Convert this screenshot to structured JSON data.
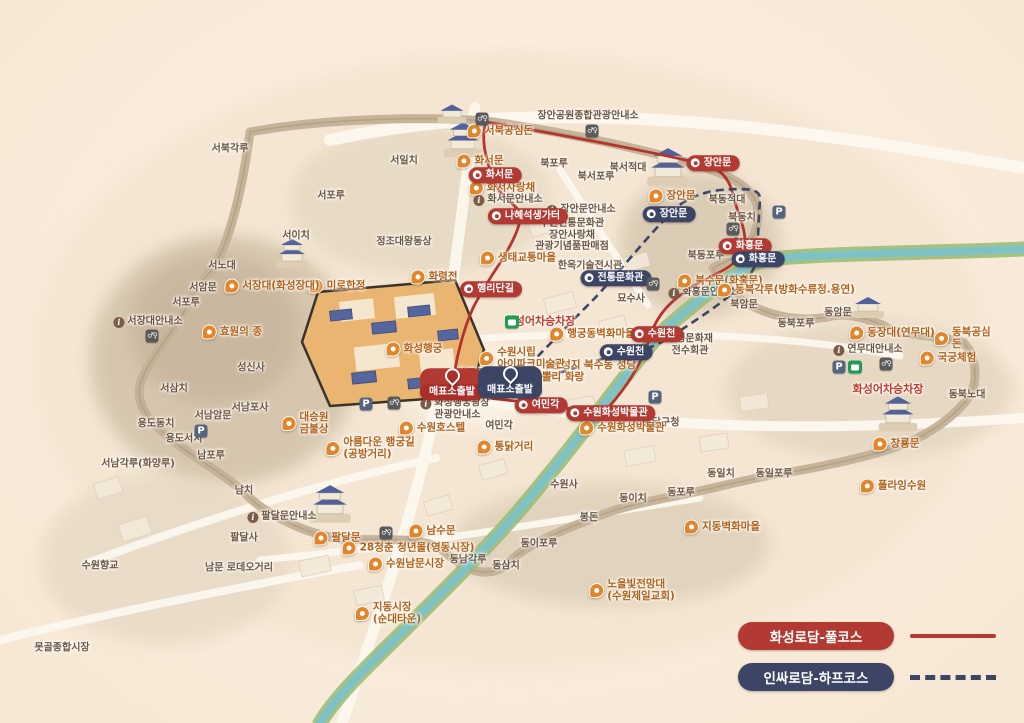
{
  "map_title": "수원 화성 관광 안내도",
  "colors": {
    "full_course_red": "#b23a33",
    "half_course_navy": "#3c4565",
    "poi_orange": "#e2862c",
    "place_brown": "#6d5640",
    "stream_green": "#9dbd74",
    "stream_water": "#7fc2c6",
    "background": "#f9ecdb"
  },
  "legend": {
    "items": [
      {
        "label": "화성로담-풀코스",
        "color": "#b23a33",
        "line": "solid"
      },
      {
        "label": "인싸로담-하프코스",
        "color": "#3c4565",
        "line": "dashed"
      }
    ]
  },
  "labels": [
    {
      "type": "place",
      "text": "장안공원종합관광안내소",
      "x": 588,
      "y": 116,
      "name": "place-jangan-park-tourist-info"
    },
    {
      "type": "place",
      "text": "서북각루",
      "x": 230,
      "y": 149,
      "name": "place-seobukgangnu"
    },
    {
      "type": "place",
      "text": "서일치",
      "x": 404,
      "y": 161,
      "name": "place-seoilchi"
    },
    {
      "type": "place",
      "text": "서포루",
      "x": 331,
      "y": 196,
      "name": "place-seoporu-1"
    },
    {
      "type": "place",
      "text": "서이치",
      "x": 296,
      "y": 236,
      "name": "place-seoichi"
    },
    {
      "type": "place",
      "text": "정조대왕동상",
      "x": 404,
      "y": 242,
      "name": "place-king-jeongjo-statue"
    },
    {
      "type": "place",
      "text": "서노대",
      "x": 222,
      "y": 266,
      "name": "place-seonodae"
    },
    {
      "type": "place",
      "text": "서암문",
      "x": 203,
      "y": 288,
      "name": "place-seoammun"
    },
    {
      "type": "place",
      "text": "서포루",
      "x": 186,
      "y": 303,
      "name": "place-seoporu-2"
    },
    {
      "type": "infoplace",
      "text": "서장대안내소",
      "x": 148,
      "y": 322,
      "name": "place-seojangdae-info"
    },
    {
      "type": "place",
      "text": "성신사",
      "x": 251,
      "y": 368,
      "name": "place-seongsinsa"
    },
    {
      "type": "place",
      "text": "서삼치",
      "x": 174,
      "y": 389,
      "name": "place-seosamchi"
    },
    {
      "type": "place",
      "text": "서남암문",
      "x": 213,
      "y": 416,
      "name": "place-seonam-ammun"
    },
    {
      "type": "place",
      "text": "서남포사",
      "x": 250,
      "y": 408,
      "name": "place-seonamposa"
    },
    {
      "type": "place",
      "text": "용도동치",
      "x": 156,
      "y": 424,
      "name": "place-yongdodongchi"
    },
    {
      "type": "place",
      "text": "용도서치",
      "x": 184,
      "y": 439,
      "name": "place-yongdoseochi"
    },
    {
      "type": "place",
      "text": "남포루",
      "x": 211,
      "y": 456,
      "name": "place-namporu"
    },
    {
      "type": "place",
      "text": "서남각루(화양루)",
      "x": 138,
      "y": 464,
      "name": "place-seonamgangnu"
    },
    {
      "type": "place",
      "text": "남치",
      "x": 244,
      "y": 491,
      "name": "place-namchi"
    },
    {
      "type": "place",
      "text": "팔달사",
      "x": 244,
      "y": 538,
      "name": "place-paldalsa"
    },
    {
      "type": "infoplace",
      "text": "팔달문안내소",
      "x": 282,
      "y": 517,
      "name": "place-paldalmun-info"
    },
    {
      "type": "place",
      "text": "남문 로데오거리",
      "x": 239,
      "y": 568,
      "name": "place-nammun-rodeo-street"
    },
    {
      "type": "place",
      "text": "수원향교",
      "x": 100,
      "y": 566,
      "name": "place-suwon-hyanggyo"
    },
    {
      "type": "place",
      "text": "못골종합시장",
      "x": 62,
      "y": 648,
      "name": "place-motgol-market"
    },
    {
      "type": "place",
      "text": "북포루",
      "x": 554,
      "y": 164,
      "name": "place-bukporu"
    },
    {
      "type": "place",
      "text": "북서포루",
      "x": 596,
      "y": 177,
      "name": "place-bukseoporu"
    },
    {
      "type": "place",
      "text": "북서적대",
      "x": 628,
      "y": 168,
      "name": "place-bukseojeokdae"
    },
    {
      "type": "place",
      "text": "북동적대",
      "x": 727,
      "y": 200,
      "name": "place-bukdongjeokdae"
    },
    {
      "type": "place",
      "text": "북동치",
      "x": 742,
      "y": 218,
      "name": "place-bukdongchi"
    },
    {
      "type": "place",
      "text": "북동포루",
      "x": 706,
      "y": 256,
      "name": "place-bukdongporu"
    },
    {
      "type": "place",
      "text": "북암문",
      "x": 744,
      "y": 305,
      "name": "place-bugammun"
    },
    {
      "type": "place",
      "text": "동암문",
      "x": 838,
      "y": 313,
      "name": "place-dongammun"
    },
    {
      "type": "place",
      "text": "동북포루",
      "x": 796,
      "y": 324,
      "name": "place-dongbukporu"
    },
    {
      "type": "place",
      "text": "동북노대",
      "x": 967,
      "y": 395,
      "name": "place-dongbuknodae"
    },
    {
      "type": "infoplace",
      "text": "연무대안내소",
      "x": 868,
      "y": 350,
      "name": "place-yeonmudae-info"
    },
    {
      "type": "place",
      "text": "동일치",
      "x": 721,
      "y": 474,
      "name": "place-dongilchi"
    },
    {
      "type": "place",
      "text": "동일포루",
      "x": 774,
      "y": 474,
      "name": "place-dongilporu"
    },
    {
      "type": "place",
      "text": "동포루",
      "x": 681,
      "y": 493,
      "name": "place-dongporu"
    },
    {
      "type": "place",
      "text": "동이치",
      "x": 633,
      "y": 499,
      "name": "place-dongichi"
    },
    {
      "type": "place",
      "text": "동이포루",
      "x": 539,
      "y": 544,
      "name": "place-dongiporu"
    },
    {
      "type": "place",
      "text": "동삼치",
      "x": 506,
      "y": 566,
      "name": "place-dongsamchi"
    },
    {
      "type": "place",
      "text": "동남각루",
      "x": 468,
      "y": 560,
      "name": "place-dongnamgangnu"
    },
    {
      "type": "place",
      "text": "봉돈",
      "x": 589,
      "y": 518,
      "name": "place-bongdon"
    },
    {
      "type": "place",
      "text": "팔달구청",
      "x": 661,
      "y": 423,
      "name": "place-paldal-gu-office"
    },
    {
      "type": "place",
      "text": "무형문화재\n전수회관",
      "x": 690,
      "y": 345,
      "name": "place-intangible-heritage-hall"
    },
    {
      "type": "place",
      "text": "행궁광장",
      "x": 476,
      "y": 374,
      "name": "place-haenggung-plaza"
    },
    {
      "type": "place",
      "text": "여민각",
      "x": 499,
      "y": 426,
      "name": "place-yeomingak"
    },
    {
      "type": "place",
      "text": "수원사",
      "x": 564,
      "y": 485,
      "name": "place-suwonsa"
    },
    {
      "type": "place",
      "text": "묘수사",
      "x": 631,
      "y": 299,
      "name": "place-myosusa"
    },
    {
      "type": "infoplace",
      "text": "장안문안내소",
      "x": 581,
      "y": 210,
      "name": "place-janganmun-info"
    },
    {
      "type": "infoplace",
      "text": "화서문안내소",
      "x": 508,
      "y": 200,
      "name": "place-hwaseomun-info"
    },
    {
      "type": "infoplace",
      "text": "화홍문안내소",
      "x": 703,
      "y": 293,
      "name": "place-hwahongmun-info"
    },
    {
      "type": "place",
      "text": "수원전통문화관\n장안사랑채\n관광기념품판매점",
      "x": 572,
      "y": 235,
      "name": "place-traditional-culture-center"
    },
    {
      "type": "place",
      "text": "한옥기술전시관",
      "x": 590,
      "y": 266,
      "name": "place-hanok-tech-hall"
    },
    {
      "type": "infoplace",
      "text": "화성행궁광장\n관광안내소",
      "x": 455,
      "y": 409,
      "name": "place-haenggung-plaza-info"
    },
    {
      "type": "pin",
      "text": "서북공심돈",
      "x": 500,
      "y": 131,
      "name": "poi-seobuk-gongsimdon"
    },
    {
      "type": "pin",
      "text": "화서문",
      "x": 480,
      "y": 161,
      "name": "poi-hwaseomun"
    },
    {
      "type": "pin",
      "text": "화서사랑채",
      "x": 502,
      "y": 188,
      "name": "poi-hwaseo-sarangchae"
    },
    {
      "type": "pin",
      "text": "생태교통마을",
      "x": 518,
      "y": 258,
      "name": "poi-ecomobility-village"
    },
    {
      "type": "pin",
      "text": "미로한정",
      "x": 337,
      "y": 286,
      "name": "poi-mirohanjeong"
    },
    {
      "type": "pin",
      "text": "화령전",
      "x": 434,
      "y": 277,
      "name": "poi-hwaryeongjeon"
    },
    {
      "type": "pin",
      "text": "화성행궁",
      "x": 414,
      "y": 349,
      "name": "poi-hwaseong-haenggung"
    },
    {
      "type": "pin",
      "text": "서장대(화성장대)",
      "x": 272,
      "y": 286,
      "name": "poi-seojangdae"
    },
    {
      "type": "pin",
      "text": "효원의 종",
      "x": 232,
      "y": 332,
      "name": "poi-hyowon-bell"
    },
    {
      "type": "pin",
      "text": "대승원\n금불상",
      "x": 305,
      "y": 423,
      "name": "poi-daeseungwon-buddha"
    },
    {
      "type": "pin",
      "text": "아름다운 행궁길\n(공방거리)",
      "x": 370,
      "y": 448,
      "name": "poi-haenggung-gil"
    },
    {
      "type": "pin",
      "text": "수원호스텔",
      "x": 432,
      "y": 428,
      "name": "poi-suwon-hostel"
    },
    {
      "type": "pin",
      "text": "통닭거리",
      "x": 505,
      "y": 447,
      "name": "poi-tongdak-street"
    },
    {
      "type": "pin",
      "text": "행궁동벽화마을",
      "x": 592,
      "y": 334,
      "name": "poi-mural-village"
    },
    {
      "type": "pin",
      "text": "수원성지 북수동 성당\n뽈리 화랑",
      "x": 580,
      "y": 371,
      "name": "poi-buksudong-cathedral"
    },
    {
      "type": "pin",
      "text": "수원화성박물관",
      "x": 622,
      "y": 428,
      "name": "poi-hwaseong-museum"
    },
    {
      "type": "pin",
      "text": "수원시립\n아이파크미술관",
      "x": 522,
      "y": 358,
      "name": "poi-ipark-art-museum"
    },
    {
      "type": "pin",
      "text": "북수문(화홍문)",
      "x": 720,
      "y": 281,
      "name": "poi-buksumun"
    },
    {
      "type": "pin",
      "text": "동북각루(방화수류정.용연)",
      "x": 786,
      "y": 290,
      "name": "poi-dongbukgangnu"
    },
    {
      "type": "pin",
      "text": "동장대(연무대)",
      "x": 892,
      "y": 333,
      "name": "poi-dongjangdae"
    },
    {
      "type": "pin",
      "text": "동북공심돈",
      "x": 964,
      "y": 338,
      "name": "poi-dongbuk-gongsimdon"
    },
    {
      "type": "pin",
      "text": "국궁체험",
      "x": 948,
      "y": 358,
      "name": "poi-archery-experience"
    },
    {
      "type": "pin",
      "text": "창룡문",
      "x": 896,
      "y": 444,
      "name": "poi-changnyongmun"
    },
    {
      "type": "pin",
      "text": "플라잉수원",
      "x": 893,
      "y": 486,
      "name": "poi-flying-suwon"
    },
    {
      "type": "pin",
      "text": "팔달문",
      "x": 337,
      "y": 538,
      "name": "poi-paldalmun"
    },
    {
      "type": "pin",
      "text": "남수문",
      "x": 432,
      "y": 531,
      "name": "poi-namsumun"
    },
    {
      "type": "pin",
      "text": "28청춘 청년몰(영동시장)",
      "x": 408,
      "y": 548,
      "name": "poi-28-youth-mall"
    },
    {
      "type": "pin",
      "text": "수원남문시장",
      "x": 406,
      "y": 564,
      "name": "poi-nammun-market"
    },
    {
      "type": "pin",
      "text": "지동시장\n(순대타운)",
      "x": 388,
      "y": 613,
      "name": "poi-jidong-market"
    },
    {
      "type": "pin",
      "text": "지동벽화마을",
      "x": 722,
      "y": 527,
      "name": "poi-jidong-mural-village"
    },
    {
      "type": "pin",
      "text": "노을빛전망대\n(수원제일교회)",
      "x": 632,
      "y": 590,
      "name": "poi-sunset-observatory"
    },
    {
      "type": "pin",
      "text": "장안문",
      "x": 672,
      "y": 196,
      "name": "poi-janganmun"
    },
    {
      "type": "badge-red",
      "text": "화서문",
      "x": 495,
      "y": 175,
      "name": "full-course-stop-hwaseomun"
    },
    {
      "type": "badge-red",
      "text": "나혜석생가터",
      "x": 528,
      "y": 216,
      "name": "full-course-stop-naehyeseok"
    },
    {
      "type": "badge-red",
      "text": "행리단길",
      "x": 491,
      "y": 289,
      "name": "full-course-stop-haengnidan-gil"
    },
    {
      "type": "badge-red",
      "text": "장안문",
      "x": 713,
      "y": 163,
      "name": "full-course-stop-janganmun"
    },
    {
      "type": "badge-red",
      "text": "화홍문",
      "x": 745,
      "y": 246,
      "name": "full-course-stop-hwahongmun"
    },
    {
      "type": "badge-red",
      "text": "수원천",
      "x": 657,
      "y": 334,
      "name": "full-course-stop-suwoncheon"
    },
    {
      "type": "badge-red",
      "text": "수원화성박물관",
      "x": 611,
      "y": 413,
      "name": "full-course-stop-museum"
    },
    {
      "type": "badge-red",
      "text": "여민각",
      "x": 541,
      "y": 405,
      "name": "full-course-stop-yeomingak"
    },
    {
      "type": "badge-navy",
      "text": "장안문",
      "x": 669,
      "y": 214,
      "name": "half-course-stop-janganmun"
    },
    {
      "type": "badge-navy",
      "text": "전통문화관",
      "x": 616,
      "y": 278,
      "name": "half-course-stop-culture-center"
    },
    {
      "type": "badge-navy",
      "text": "화홍문",
      "x": 758,
      "y": 259,
      "name": "half-course-stop-hwahongmun"
    },
    {
      "type": "badge-navy",
      "text": "수원천",
      "x": 626,
      "y": 352,
      "name": "half-course-stop-suwoncheon"
    },
    {
      "type": "start-red",
      "text": "매표소출발",
      "x": 452,
      "y": 384,
      "name": "full-course-start-ticket-office"
    },
    {
      "type": "start-navy",
      "text": "매표소출발",
      "x": 510,
      "y": 382,
      "name": "half-course-start-ticket-office"
    },
    {
      "type": "redtext",
      "text": "화성어차승차장",
      "x": 540,
      "y": 322,
      "name": "trolley-stop-west"
    },
    {
      "type": "redtext",
      "text": "화성어차승차장",
      "x": 888,
      "y": 390,
      "name": "trolley-stop-east"
    },
    {
      "type": "icon-bus",
      "text": "",
      "x": 512,
      "y": 322,
      "name": "bus-icon"
    },
    {
      "type": "icon-bus",
      "text": "",
      "x": 855,
      "y": 367,
      "name": "bus-icon"
    },
    {
      "type": "icon-parking",
      "text": "P",
      "x": 779,
      "y": 212,
      "name": "parking-icon"
    },
    {
      "type": "icon-parking",
      "text": "P",
      "x": 655,
      "y": 397,
      "name": "parking-icon"
    },
    {
      "type": "icon-parking",
      "text": "P",
      "x": 366,
      "y": 404,
      "name": "parking-icon"
    },
    {
      "type": "icon-parking",
      "text": "P",
      "x": 201,
      "y": 431,
      "name": "parking-icon"
    },
    {
      "type": "icon-parking",
      "text": "P",
      "x": 839,
      "y": 367,
      "name": "parking-icon"
    },
    {
      "type": "icon-toilet",
      "text": "♂♀",
      "x": 592,
      "y": 131,
      "name": "restroom-icon"
    },
    {
      "type": "icon-toilet",
      "text": "♂♀",
      "x": 733,
      "y": 229,
      "name": "restroom-icon"
    },
    {
      "type": "icon-toilet",
      "text": "♂♀",
      "x": 653,
      "y": 284,
      "name": "restroom-icon"
    },
    {
      "type": "icon-toilet",
      "text": "♂♀",
      "x": 394,
      "y": 403,
      "name": "restroom-icon"
    },
    {
      "type": "icon-toilet",
      "text": "♂♀",
      "x": 886,
      "y": 364,
      "name": "restroom-icon"
    },
    {
      "type": "icon-toilet",
      "text": "♂♀",
      "x": 386,
      "y": 533,
      "name": "restroom-icon"
    },
    {
      "type": "icon-toilet",
      "text": "♂♀",
      "x": 152,
      "y": 336,
      "name": "restroom-icon"
    },
    {
      "type": "icon-toilet",
      "text": "♂♀",
      "x": 482,
      "y": 119,
      "name": "restroom-icon"
    }
  ]
}
